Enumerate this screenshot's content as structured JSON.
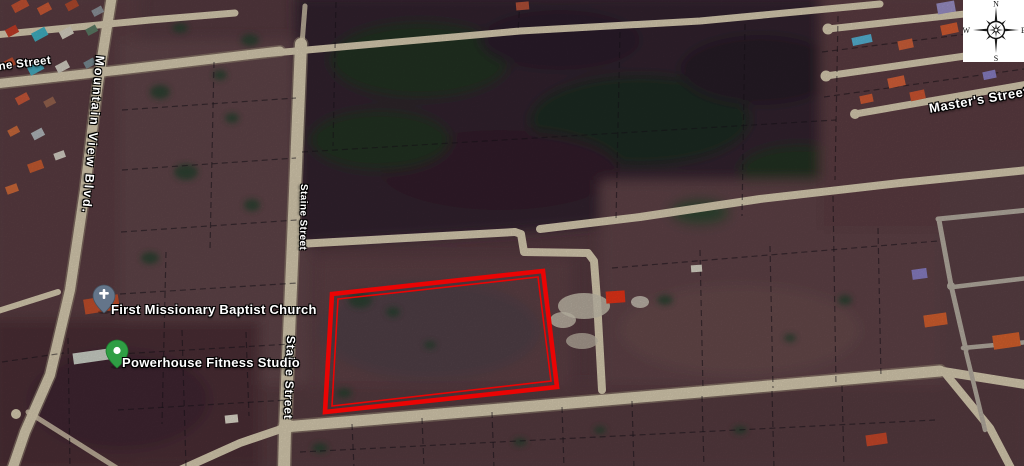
{
  "map": {
    "street_labels": [
      {
        "id": "ne-street",
        "text": "ne Street"
      },
      {
        "id": "mountain-view-blvd",
        "text": "Mountain View Blvd."
      },
      {
        "id": "staine-street-upper",
        "text": "Staine Street"
      },
      {
        "id": "staine-street-lower",
        "text": "Staine Street"
      },
      {
        "id": "masters-street",
        "text": "Master's Street"
      }
    ],
    "places": [
      {
        "id": "first-missionary-baptist-church",
        "label": "First Missionary Baptist Church",
        "pin": "church-pin"
      },
      {
        "id": "powerhouse-fitness-studio",
        "label": "Powerhouse Fitness Studio",
        "pin": "green-pin"
      }
    ],
    "parcel": {
      "outline_points": "332,294 543,271 557,387 325,412",
      "inner_points": "338,299 538,277 551,381 332,406",
      "color": "#ea0404"
    },
    "compass": {
      "n": "N",
      "e": "E",
      "s": "S",
      "w": "W"
    }
  }
}
